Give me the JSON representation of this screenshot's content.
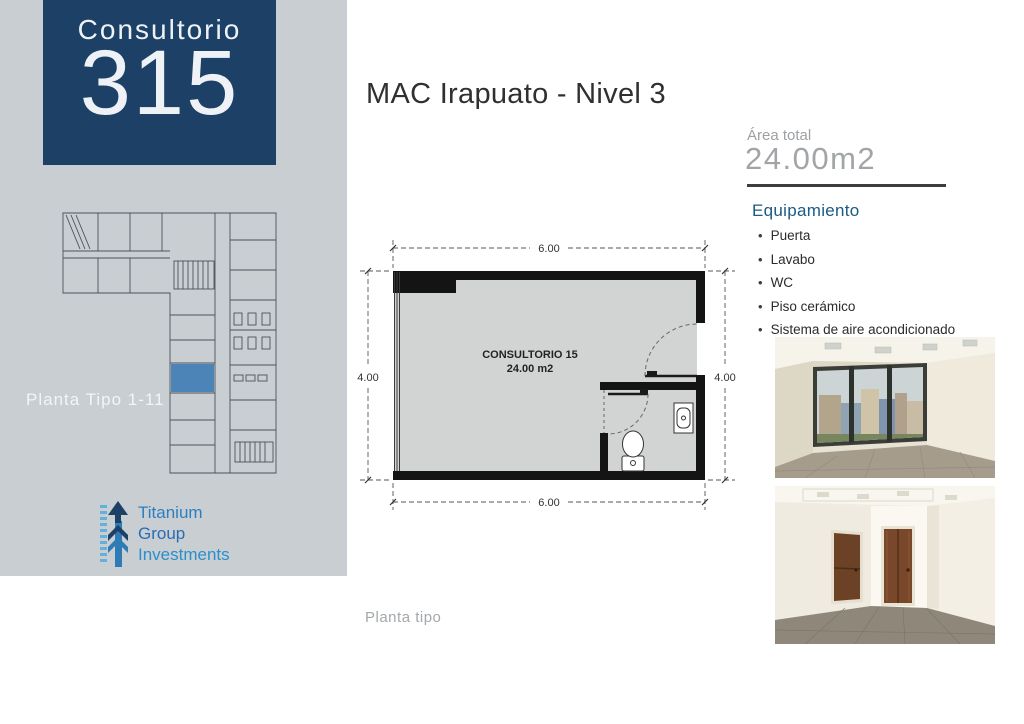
{
  "sidebar": {
    "bg": "#c9ced3",
    "unit_card": {
      "label": "Consultorio",
      "number": "315",
      "bg": "#1d4166",
      "text_color": "#eef2f6"
    },
    "mini_plan": {
      "caption": "Planta Tipo 1-11",
      "line_color": "#4b5158",
      "highlight_color": "#4d84b8"
    },
    "logo": {
      "lines": [
        "Titanium",
        "Group",
        "Investments"
      ],
      "colors": [
        "#2b7fc0",
        "#2a6cb4",
        "#2b8fcb"
      ],
      "icon_dark": "#1d4166",
      "icon_mid": "#2e7bb5",
      "icon_light": "#63b0da"
    }
  },
  "header": {
    "title": "MAC Irapuato - Nivel 3"
  },
  "details": {
    "area_label": "Área total",
    "area_value": "24.00m2",
    "equipment_title": "Equipamiento",
    "equipment_items": [
      "Puerta",
      "Lavabo",
      "WC",
      "Piso cerámico",
      "Sistema de aire acondicionado"
    ],
    "accent_color": "#1b5a82"
  },
  "floorplan": {
    "room_label": "CONSULTORIO 15",
    "room_area": "24.00 m2",
    "dim_top": "6.00",
    "dim_bottom": "6.00",
    "dim_left": "4.00",
    "dim_right": "4.00",
    "caption": "Planta tipo",
    "wall_color": "#141414",
    "floor_color": "#d2d4d3"
  }
}
